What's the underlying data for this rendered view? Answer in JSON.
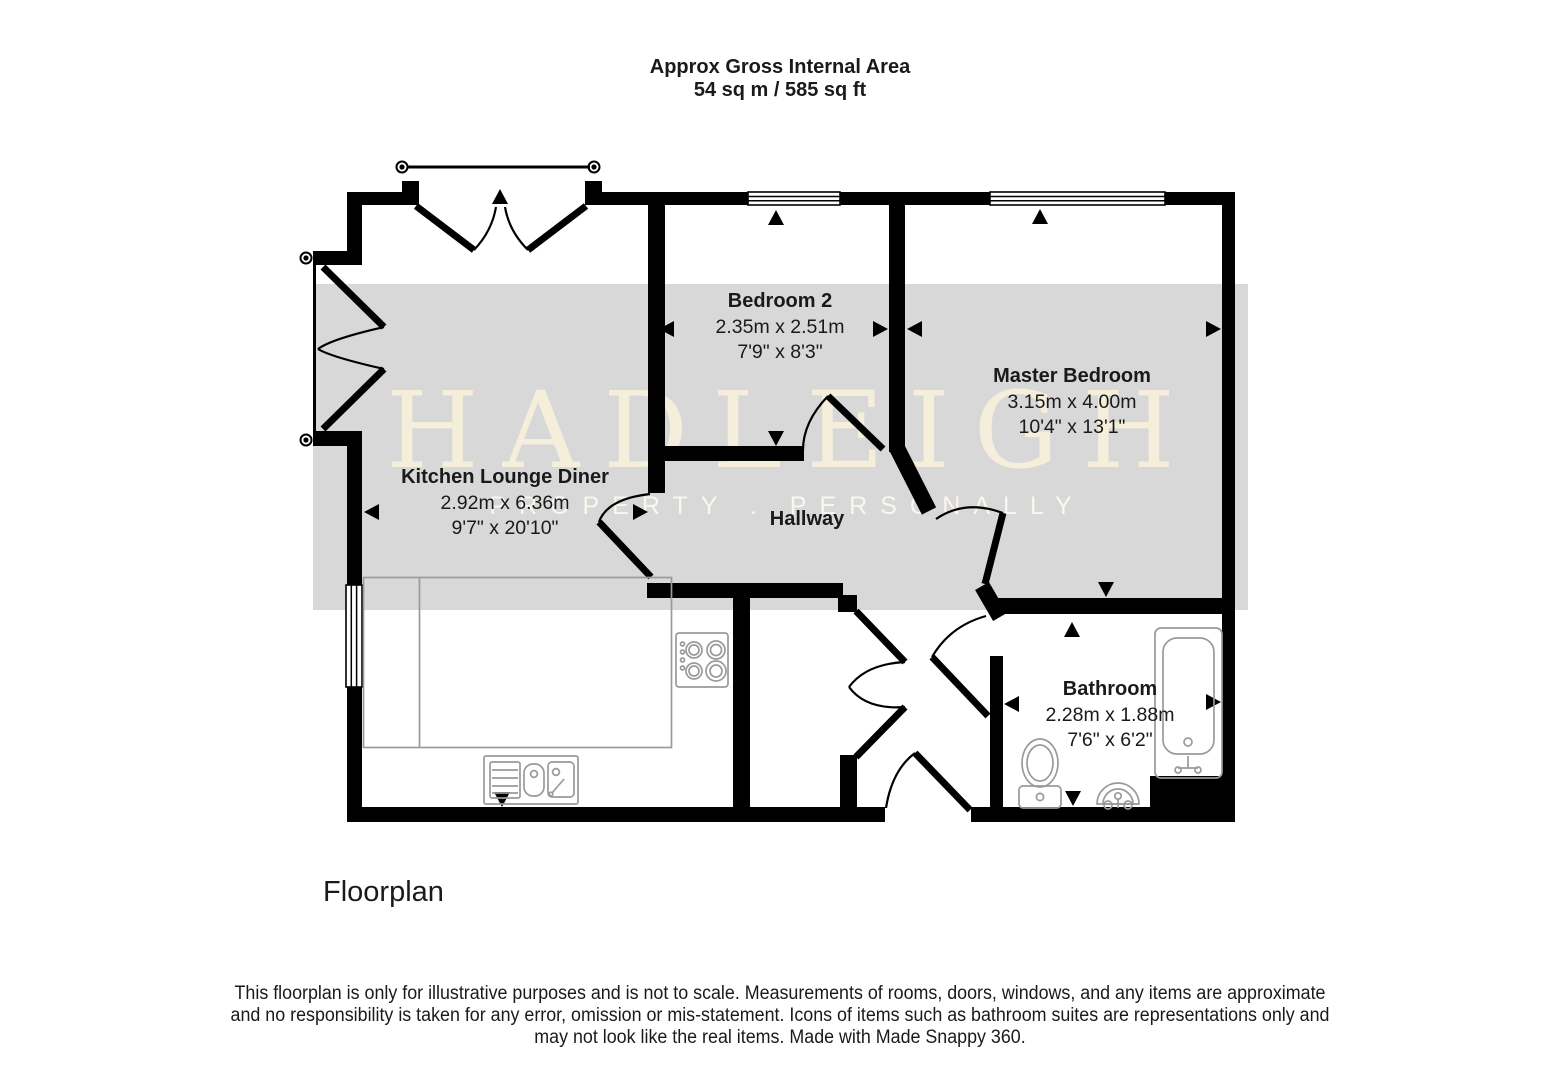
{
  "title": {
    "line1": "Approx Gross Internal Area",
    "line2": "54 sq m / 585 sq ft"
  },
  "watermark": {
    "brand": "HADLEIGH",
    "tagline": "PROPERTY . PERSONALLY"
  },
  "rooms": {
    "kitchen": {
      "name": "Kitchen Lounge Diner",
      "metric": "2.92m x 6.36m",
      "imperial": "9'7\" x 20'10\""
    },
    "bedroom2": {
      "name": "Bedroom 2",
      "metric": "2.35m x 2.51m",
      "imperial": "7'9\" x 8'3\""
    },
    "master": {
      "name": "Master Bedroom",
      "metric": "3.15m x 4.00m",
      "imperial": "10'4\" x 13'1\""
    },
    "hallway": {
      "name": "Hallway"
    },
    "bathroom": {
      "name": "Bathroom",
      "metric": "2.28m x 1.88m",
      "imperial": "7'6\" x 6'2\""
    }
  },
  "footer": {
    "plan_label": "Floorplan"
  },
  "disclaimer": {
    "line1": "This floorplan is only for illustrative purposes and is not to scale. Measurements of rooms, doors, windows, and any items are approximate",
    "line2": "and no responsibility is taken for any error, omission or mis-statement. Icons of items such as bathroom suites are representations only and",
    "line3": "may not look like the real items. Made with Made Snappy 360."
  },
  "colors": {
    "wall": "#000000",
    "band": "#d8d8d8",
    "watermark_brand": "#f5eedb",
    "watermark_tagline": "#faf7ee",
    "fixture": "#9a9a9a",
    "text": "#1a1a1a"
  }
}
